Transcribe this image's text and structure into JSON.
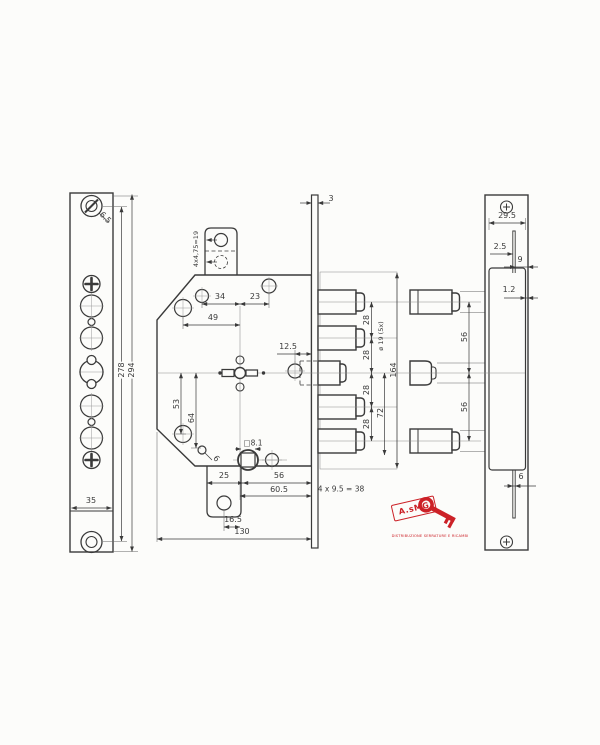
{
  "canvas": {
    "background": "#fcfcfa",
    "ink": "#3a3a3a",
    "accent_red": "#cc2127"
  },
  "left_view": {
    "screw_dia": "6.5",
    "width": "35",
    "height_inner": "278",
    "height_overall": "294"
  },
  "main_view": {
    "tab_pitch": "4x4,75=19",
    "faceplate_thickness": "3",
    "dim_34": "34",
    "dim_23": "23",
    "dim_49": "49",
    "dim_12_5": "12.5",
    "dim_53": "53",
    "dim_64": "64",
    "hole_dia_6": "6",
    "spindle_square": "□8.1",
    "dim_25": "25",
    "dim_56": "56",
    "dim_60_5": "60.5",
    "dim_16_5": "16.5",
    "overall_width": "130",
    "screw_formula": "4 x 9.5 = 38"
  },
  "bolts": {
    "pitch_1": "28",
    "pitch_2": "28",
    "pitch_3": "28",
    "pitch_4": "28",
    "diameter": "ø 19 (5x)",
    "overall_span": "164",
    "dim_72": "72",
    "side_pitch_1": "56",
    "side_pitch_2": "56"
  },
  "right_view": {
    "width": "29.5",
    "dim_2_5": "2.5",
    "dim_9": "9",
    "sheet_thickness": "1.2",
    "dim_6": "6"
  },
  "logo": {
    "brand": "A.sMG",
    "caption": "DISTRIBUZIONE SERRATURE E RICAMBI"
  }
}
